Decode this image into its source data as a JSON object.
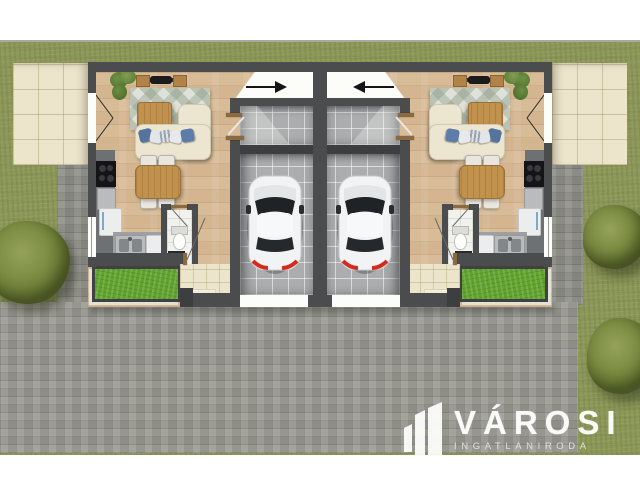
{
  "logo": {
    "title": "VÁROSI",
    "tagline": "INGATLANIRODA"
  },
  "palette": {
    "white_margin": "#ffffff",
    "lawn": "#8d9859",
    "paving": "#9b9b94",
    "wall": "#4a4c4e",
    "wood_floor": "#d8bc98",
    "terrace": "#ece4cb",
    "garage_tile": "#abadae",
    "planter_green": "#61a22d",
    "car_body": "#f2f3f4",
    "taillight_red": "#d42b20",
    "sofa": "#ece5d0",
    "table_wood": "#c1914e",
    "pillow_blue": "#54749e"
  },
  "plan": {
    "unit_count": 2,
    "mirrored": true,
    "per_unit_features": [
      "living-room",
      "dining-table",
      "kitchen",
      "bathroom",
      "entry-hall",
      "garage-with-car",
      "terrace",
      "planter-bed"
    ]
  }
}
